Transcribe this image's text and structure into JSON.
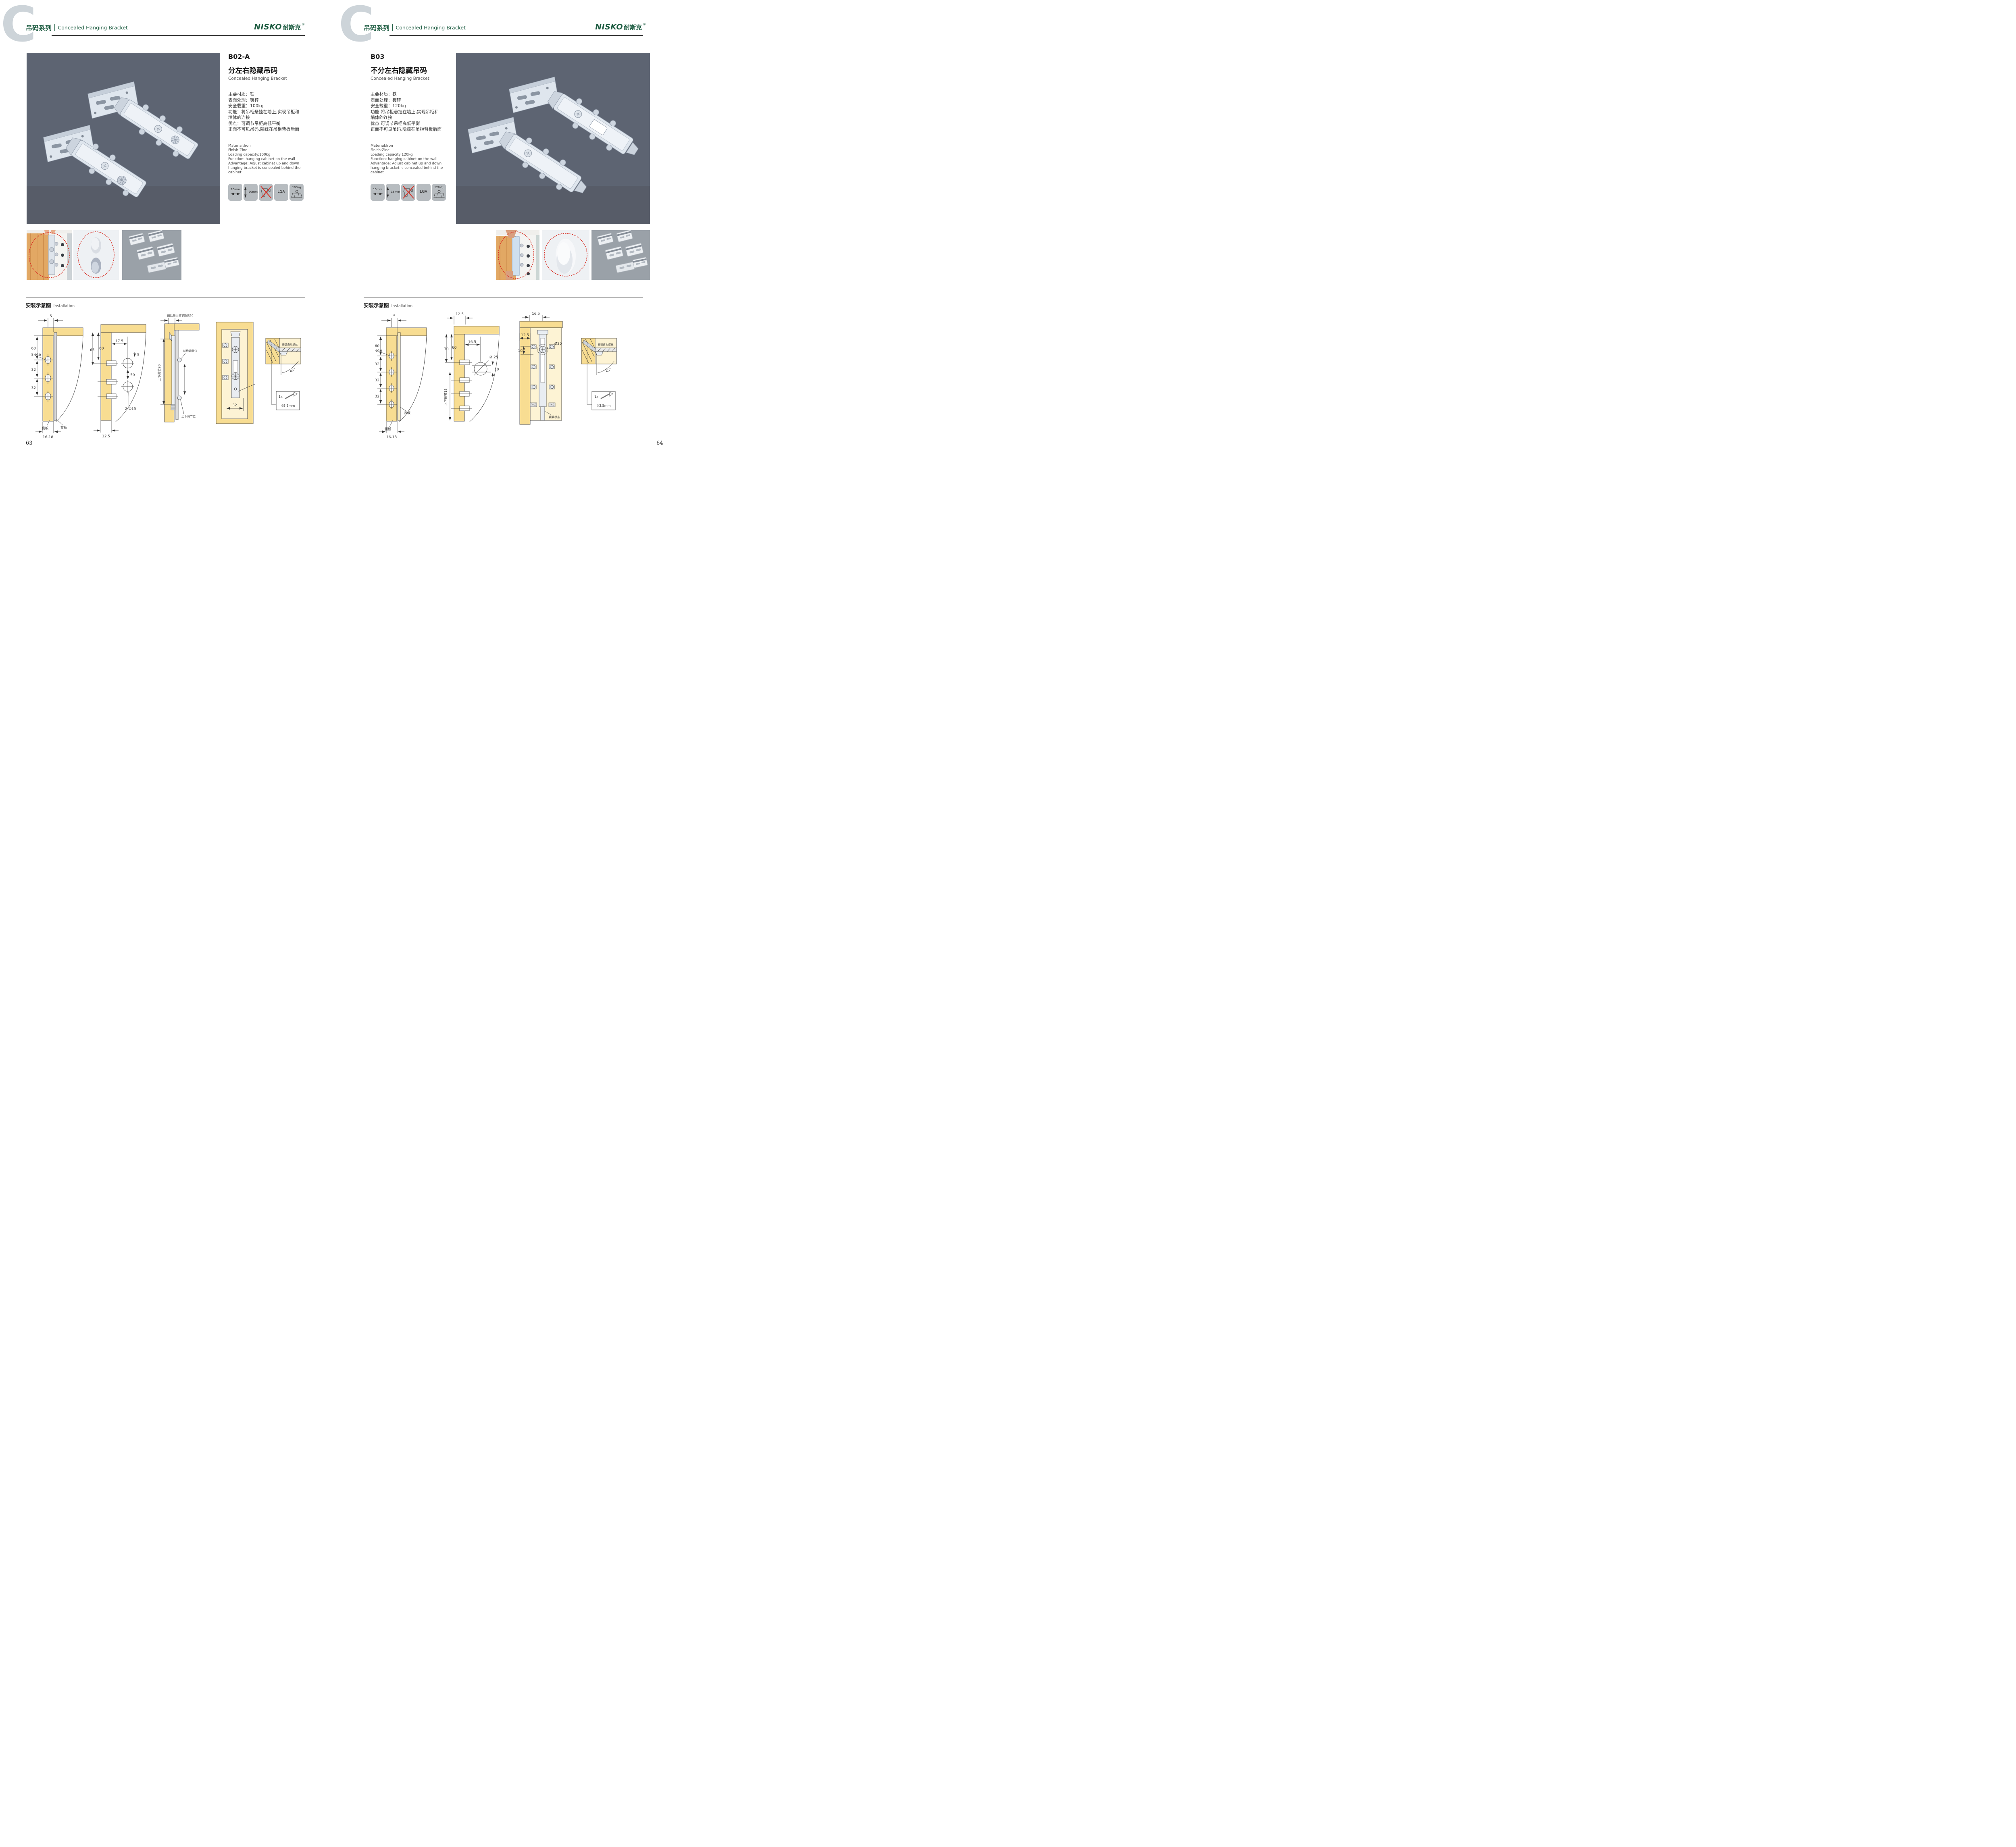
{
  "colors": {
    "brand_green": "#1d5c41",
    "accent_red": "#d93025",
    "photo_background": "#5d6472",
    "diagram_wood": "#f8dd92"
  },
  "header": {
    "letter": "C",
    "series_zh": "吊码系列",
    "series_en": "Concealed Hanging Bracket",
    "brand": "NISKO",
    "brand_zh": "耐斯克",
    "registered": "®"
  },
  "install": {
    "zh": "安装示意图",
    "en": "Installation"
  },
  "left": {
    "page_number": "63",
    "code": "B02-A",
    "name_zh": "分左右隐藏吊码",
    "name_en": "Concealed Hanging Bracket",
    "specs_zh": [
      "主要材质：铁",
      "表面处理：镀锌",
      "安全载重：100kg",
      "功能：将吊柜悬挂在墙上,实现吊柜和",
      "墙体的连接",
      "优点：可调节吊柜高低平衡",
      "正面不可见吊码,隐藏在吊柜背板后面"
    ],
    "specs_en": [
      "Material:Iron",
      "Finish:Zinc",
      "Loading capacity:100kg",
      "Function: hanging cabinet on the wall",
      "Advantage: Adjust cabinet up and down",
      "hanging bracket is concealed behind the cabinet"
    ],
    "icons": {
      "width": "20mm",
      "height": "20mm",
      "cert": "LGA",
      "load": "100kg"
    },
    "d1": {
      "top": "5",
      "v1": "60",
      "hole": "3-Φ10",
      "v2": "32",
      "v3": "32",
      "side": "侧板",
      "back": "背板",
      "bottom": "16-18"
    },
    "d2": {
      "h1": "17.5",
      "v0": "65",
      "v1": "60",
      "gap": "5",
      "v2": "50",
      "hole": "2-Φ15",
      "bottom": "12.5"
    },
    "d3": {
      "top": "前后最大调节距离20",
      "side": "上下调节20",
      "lab1": "前后调节位",
      "lab2": "上下调节位"
    },
    "d4": {
      "dim": "32"
    },
    "screw": {
      "label": "安装自攻螺丝",
      "angle": "45°",
      "qty": "1x",
      "dia": "Φ3.5mm"
    }
  },
  "right": {
    "page_number": "64",
    "code": "B03",
    "name_zh": "不分左右隐藏吊码",
    "name_en": "Concealed Hanging Bracket",
    "specs_zh": [
      "主要材质：铁",
      "表面处理：镀锌",
      "安全载重：120kg",
      "功能:将吊柜悬挂在墙上,实现吊柜和",
      "墙体的连接",
      "优点:可调节吊柜高低平衡",
      "正面不可见吊码,隐藏在吊柜背板后面"
    ],
    "specs_en": [
      "Material:Iron",
      "Finish:Zinc",
      "Loading capacity:120kg",
      "Function: hanging cabinet on the wall",
      "Advantage: Adjust cabinet up and down",
      "hanging bracket is concealed behind the cabinet"
    ],
    "icons": {
      "width": "15mm",
      "height": "18mm",
      "cert": "LGA",
      "load": "120Kg"
    },
    "d1": {
      "top": "5",
      "v1": "60",
      "hole": "Φ10",
      "v2": "32",
      "v3": "32",
      "v4": "32",
      "side": "侧板",
      "back": "背板",
      "bottom": "16-18"
    },
    "d2": {
      "top": "12.5",
      "v0": "70",
      "v1": "60",
      "h1": "16.5",
      "hole": "Ø 25",
      "off": "10",
      "side": "上下调节18"
    },
    "d3": {
      "top": "16.5",
      "h1": "12.5",
      "off": "10",
      "hole": "Ø25",
      "state": "锁紧状态"
    },
    "screw": {
      "label": "安装自攻螺丝",
      "angle": "45°",
      "qty": "1x",
      "dia": "Φ3.5mm"
    }
  }
}
